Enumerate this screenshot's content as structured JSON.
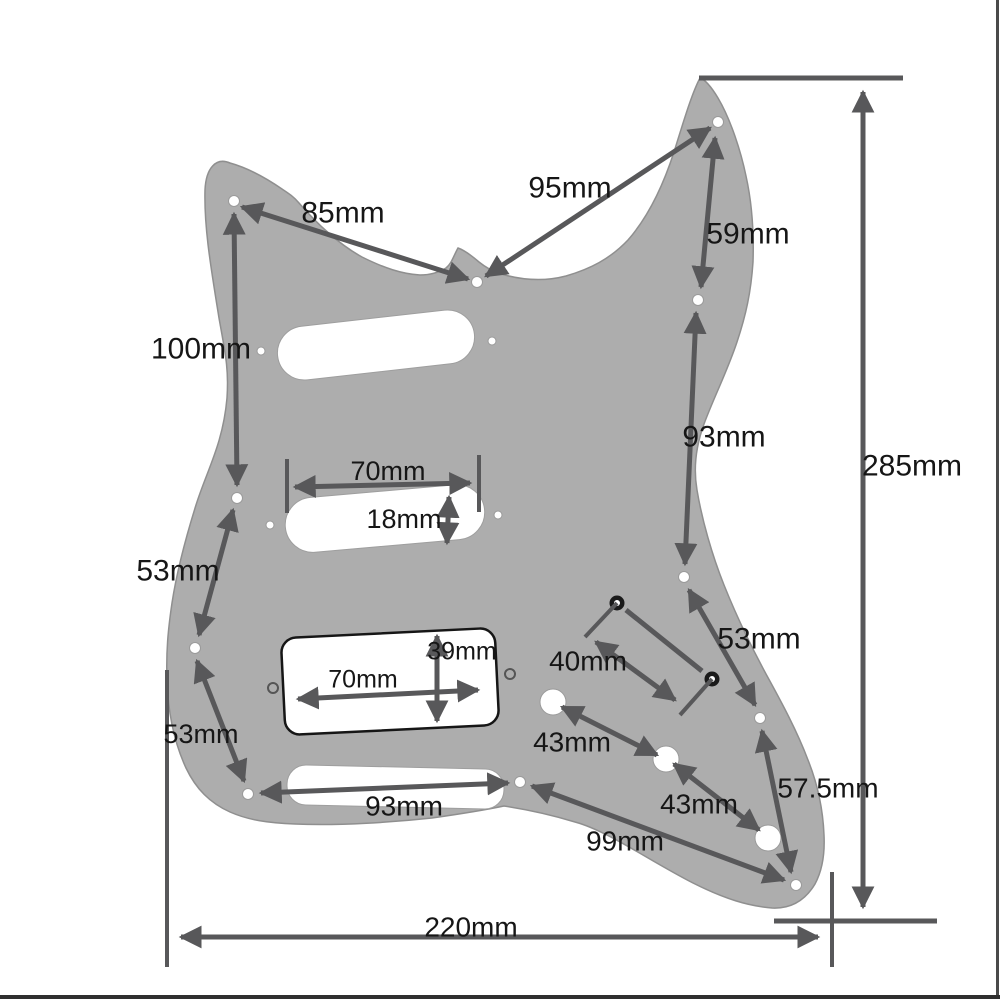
{
  "diagram": {
    "type": "technical-dimension-drawing",
    "subject": "guitar-pickguard-hss",
    "unit": "mm"
  },
  "colors": {
    "background": "#ffffff",
    "pickguard": "#adadad",
    "line": "#58585a",
    "text": "#161616",
    "holeFill": "#ffffff",
    "humbuckerOutline": "#161616"
  },
  "labels": [
    {
      "id": "85mm",
      "text": "85mm",
      "x": 343,
      "y": 215,
      "size": 30
    },
    {
      "id": "95mm",
      "text": "95mm",
      "x": 570,
      "y": 190,
      "size": 30
    },
    {
      "id": "59mm",
      "text": "59mm",
      "x": 748,
      "y": 236,
      "size": 30
    },
    {
      "id": "93mm-right",
      "text": "93mm",
      "x": 724,
      "y": 439,
      "size": 30
    },
    {
      "id": "285mm",
      "text": "285mm",
      "x": 912,
      "y": 468,
      "size": 30
    },
    {
      "id": "100mm",
      "text": "100mm",
      "x": 201,
      "y": 351,
      "size": 30
    },
    {
      "id": "70mm-middle",
      "text": "70mm",
      "x": 388,
      "y": 473,
      "size": 27
    },
    {
      "id": "18mm",
      "text": "18mm",
      "x": 404,
      "y": 521,
      "size": 27
    },
    {
      "id": "53mm-left-upper",
      "text": "53mm",
      "x": 178,
      "y": 573,
      "size": 30
    },
    {
      "id": "53mm-left-lower",
      "text": "53mm",
      "x": 201,
      "y": 736,
      "size": 27
    },
    {
      "id": "39mm",
      "text": "39mm",
      "x": 462,
      "y": 653,
      "size": 25
    },
    {
      "id": "70mm-humbucker",
      "text": "70mm",
      "x": 363,
      "y": 681,
      "size": 25
    },
    {
      "id": "40mm",
      "text": "40mm",
      "x": 588,
      "y": 663,
      "size": 28
    },
    {
      "id": "53mm-right",
      "text": "53mm",
      "x": 759,
      "y": 641,
      "size": 30
    },
    {
      "id": "43mm-upper",
      "text": "43mm",
      "x": 572,
      "y": 744,
      "size": 28
    },
    {
      "id": "43mm-lower",
      "text": "43mm",
      "x": 699,
      "y": 806,
      "size": 28
    },
    {
      "id": "57-5mm",
      "text": "57.5mm",
      "x": 828,
      "y": 790,
      "size": 28
    },
    {
      "id": "99mm",
      "text": "99mm",
      "x": 625,
      "y": 843,
      "size": 28
    },
    {
      "id": "93mm-bottom",
      "text": "93mm",
      "x": 404,
      "y": 808,
      "size": 28
    },
    {
      "id": "220mm",
      "text": "220mm",
      "x": 471,
      "y": 929,
      "size": 28
    }
  ]
}
